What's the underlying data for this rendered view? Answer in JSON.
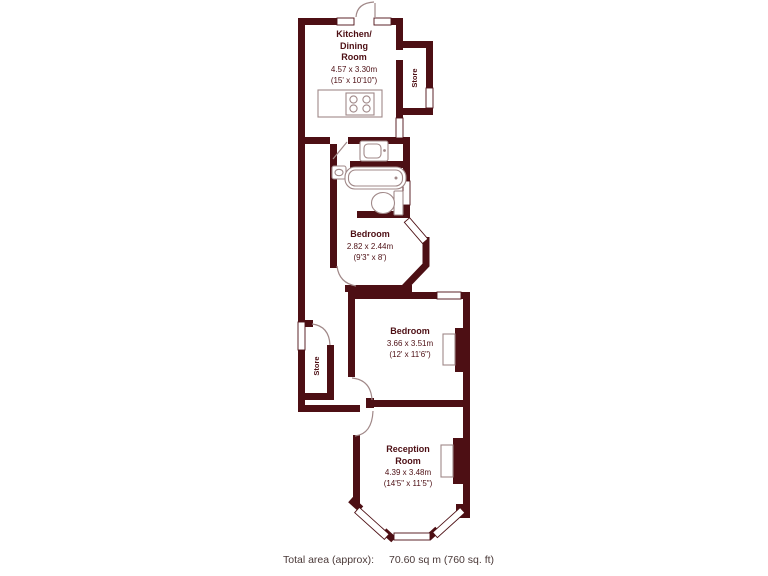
{
  "colors": {
    "wall": "#4d0f14",
    "line": "#a08888",
    "footer": "#4a3938"
  },
  "rooms": {
    "kitchen": {
      "name_lines": [
        "Kitchen/",
        "Dining",
        "Room"
      ],
      "dims_m": "4.57 x 3.30m",
      "dims_ft": "(15' x 10'10\")"
    },
    "store_top": {
      "name": "Store"
    },
    "bedroom_small": {
      "name": "Bedroom",
      "dims_m": "2.82 x 2.44m",
      "dims_ft": "(9'3\" x 8')"
    },
    "bedroom_large": {
      "name": "Bedroom",
      "dims_m": "3.66 x 3.51m",
      "dims_ft": "(12' x 11'6\")"
    },
    "store_hall": {
      "name": "Store"
    },
    "reception": {
      "name_lines": [
        "Reception",
        "Room"
      ],
      "dims_m": "4.39 x 3.48m",
      "dims_ft": "(14'5\" x 11'5\")"
    }
  },
  "footer": {
    "label": "Total area (approx):",
    "value": "70.60 sq m (760 sq. ft)"
  }
}
